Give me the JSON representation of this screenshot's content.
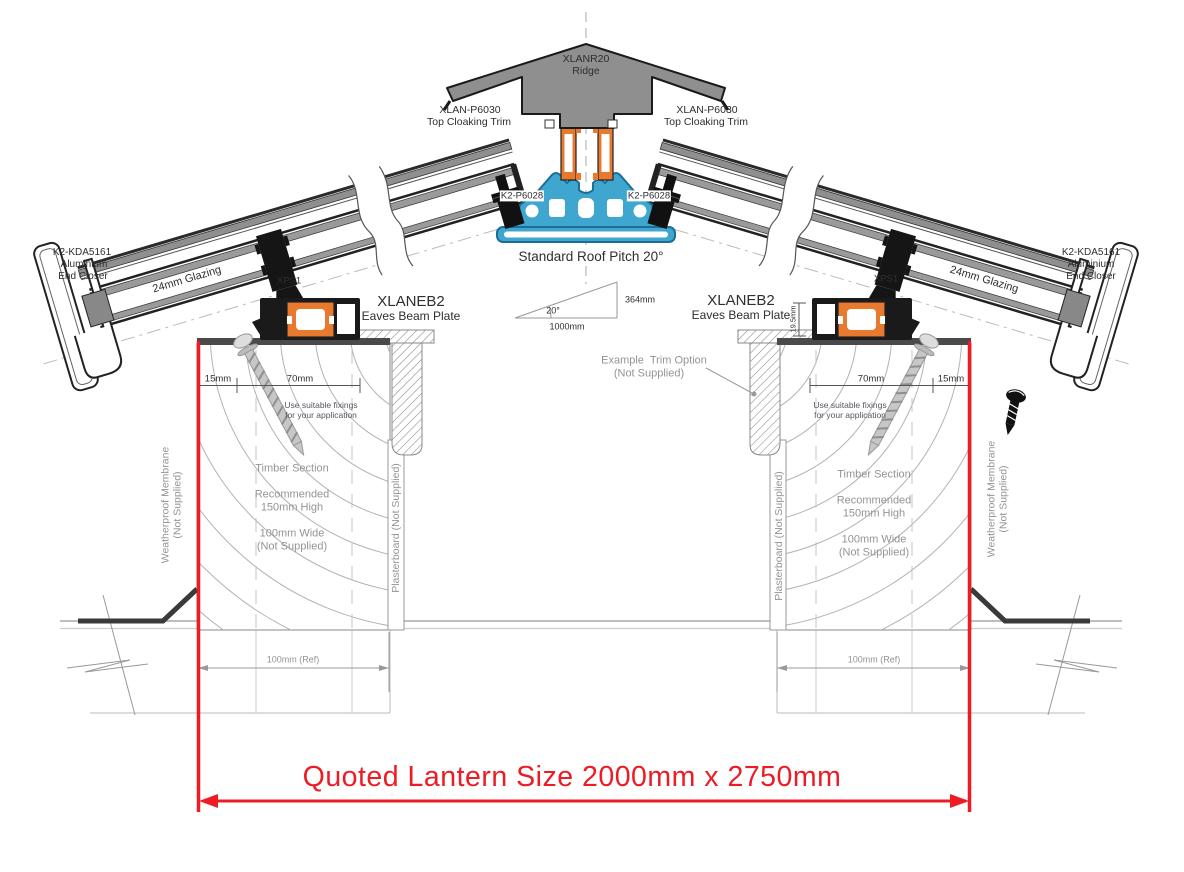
{
  "colors": {
    "accent_red": "#ED1C24",
    "profile_blue": "#3FA6CF",
    "profile_orange": "#E87A30",
    "profile_gray": "#8F8F8F"
  },
  "ridge": {
    "part": "XLANR20",
    "name": "Ridge"
  },
  "cloaking": {
    "part": "XLAN-P6030",
    "name": "Top Cloaking Trim"
  },
  "glazing_bar": {
    "part": "K2-P6028"
  },
  "pitch": {
    "note": "Standard Roof Pitch 20°",
    "angle": "20°",
    "rise": "364mm",
    "run": "1000mm"
  },
  "end_closer": {
    "line1": "K2-KDA5161",
    "line2": "Aluminium",
    "line3": "End Closer"
  },
  "glazing": {
    "label": "24mm Glazing"
  },
  "xps": {
    "label": "XPS1"
  },
  "eaves_beam": {
    "part": "XLANEB2",
    "name": "Eaves Beam Plate"
  },
  "trim_option": {
    "line1": "Example  Trim Option",
    "line2": "(Not Supplied)"
  },
  "fixings": {
    "line1": "Use suitable fixings",
    "line2": "for your application"
  },
  "dimensions": {
    "edge": "15mm",
    "beam": "70mm",
    "beam_height": "19.5mm",
    "ref": "100mm (Ref)"
  },
  "timber": {
    "lines": [
      "Timber Section",
      "Recommended",
      "150mm High",
      "100mm Wide",
      "(Not Supplied)"
    ]
  },
  "membrane": {
    "line1": "Weatherproof Membrane",
    "line2": "(Not Supplied)"
  },
  "plasterboard": {
    "label": "Plasterboard (Not Supplied)"
  },
  "quote": {
    "label": "Quoted Lantern Size 2000mm x 2750mm"
  }
}
